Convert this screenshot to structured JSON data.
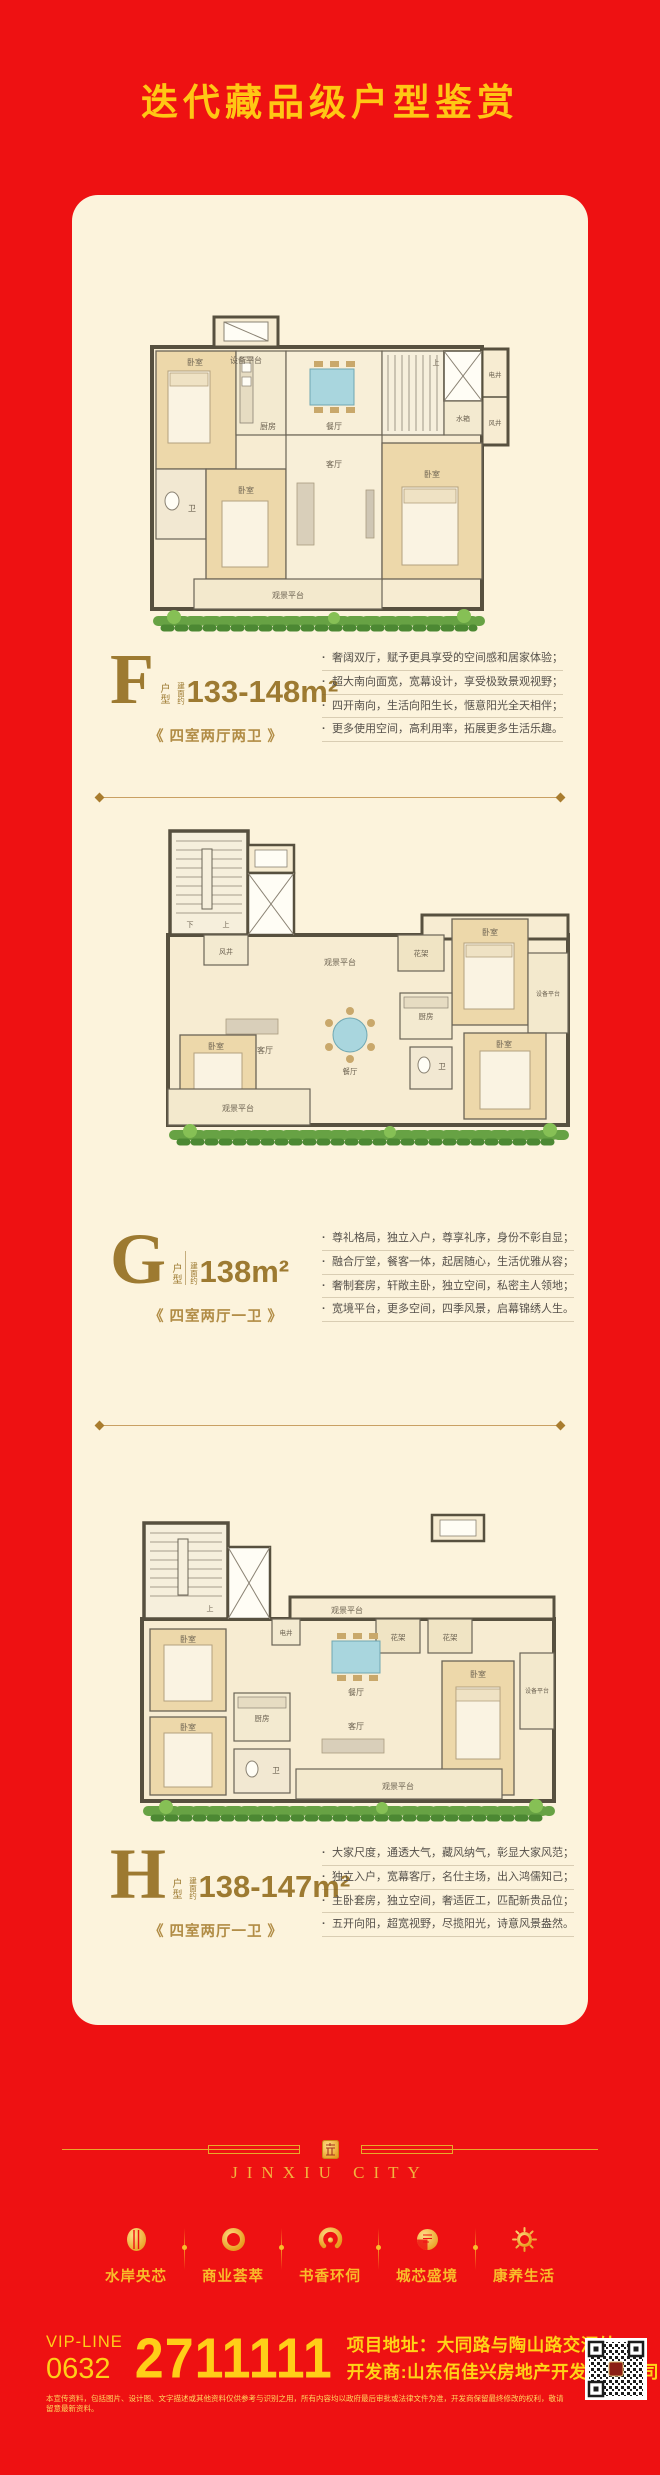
{
  "page": {
    "title": "迭代藏品级户型鉴赏"
  },
  "colors": {
    "background": "#ee1112",
    "title_gold": "#ffc714",
    "card": "#fcf3dc",
    "bronze": "#9d7a31",
    "footer_gold": "#f9bd2a"
  },
  "units": [
    {
      "letter": "F",
      "letter_suffix": "户型",
      "area_prefix": "建面约",
      "area": "133-148m²",
      "rooms_label": "《 四室两厅两卫 》",
      "bullets": [
        "奢阔双厅，赋予更具享受的空间感和居家体验；",
        "超大南向面宽，宽幕设计，享受极致景观视野；",
        "四开南向，生活向阳生长，惬意阳光全天相伴；",
        "更多使用空间，高利用率，拓展更多生活乐趣。"
      ],
      "plan_labels": {
        "equip": "设备平台",
        "tank": "水箱",
        "eshaft": "电井",
        "vshaft": "风井",
        "up": "上",
        "bed1": "卧室",
        "bed2": "卧室",
        "bed3": "卧室",
        "bath": "卫",
        "kitchen": "厨房",
        "dining": "餐厅",
        "living": "客厅",
        "balcony": "观景平台"
      }
    },
    {
      "letter": "G",
      "letter_suffix": "户型",
      "area_prefix": "建面约",
      "area": "138m²",
      "rooms_label": "《 四室两厅一卫 》",
      "bullets": [
        "尊礼格局，独立入户，尊享礼序，身份不彰自显；",
        "融合厅堂，餐客一体，起居随心，生活优雅从容；",
        "奢制套房，轩敞主卧，独立空间，私密主人领地；",
        "宽境平台，更多空间，四季风景，启幕锦绣人生。"
      ],
      "plan_labels": {
        "down": "下",
        "up": "上",
        "vshaft": "风井",
        "view": "观景平台",
        "flower": "花架",
        "equip": "设备平台",
        "bed1": "卧室",
        "bed2": "卧室",
        "bed3": "卧室",
        "bath": "卫",
        "kitchen": "厨房",
        "dining": "餐厅",
        "living": "客厅",
        "balcony": "观景平台"
      }
    },
    {
      "letter": "H",
      "letter_suffix": "户型",
      "area_prefix": "建面约",
      "area": "138-147m²",
      "rooms_label": "《 四室两厅一卫 》",
      "bullets": [
        "大家尺度，通透大气，藏风纳气，彰显大家风范；",
        "独立入户，宽幕客厅，名仕主场，出入鸿儒知己；",
        "主卧套房，独立空间，奢适匠工，匹配新贵品位；",
        "五开向阳，超宽视野，尽揽阳光，诗意风景盎然。"
      ],
      "plan_labels": {
        "up": "上",
        "view": "观景平台",
        "flower1": "花架",
        "flower2": "花架",
        "equip": "设备平台",
        "eshaft": "电井",
        "bed1": "卧室",
        "bed2": "卧室",
        "bed3": "卧室",
        "bath": "卫",
        "kitchen": "厨房",
        "dining": "餐厅",
        "living": "客厅",
        "balcony": "观景平台"
      }
    }
  ],
  "footer": {
    "brand": "JINXIU CITY",
    "features": [
      {
        "label": "水岸央芯"
      },
      {
        "label": "商业荟萃"
      },
      {
        "label": "书香环伺"
      },
      {
        "label": "城芯盛境"
      },
      {
        "label": "康养生活"
      }
    ],
    "contact": {
      "vip_line": "VIP-LINE",
      "area_code": "0632",
      "phone": "2711111",
      "address": "项目地址：大同路与陶山路交汇处",
      "developer": "开发商:山东佰佳兴房地产开发有限公司"
    },
    "disclaimer": "本宣传资料，包括图片、设计图、文字描述或其他资料仅供参考与识别之用，所有内容均以政府最后审批或法律文件为准，开发商保留最终修改的权利，敬请留意最新资料。"
  }
}
